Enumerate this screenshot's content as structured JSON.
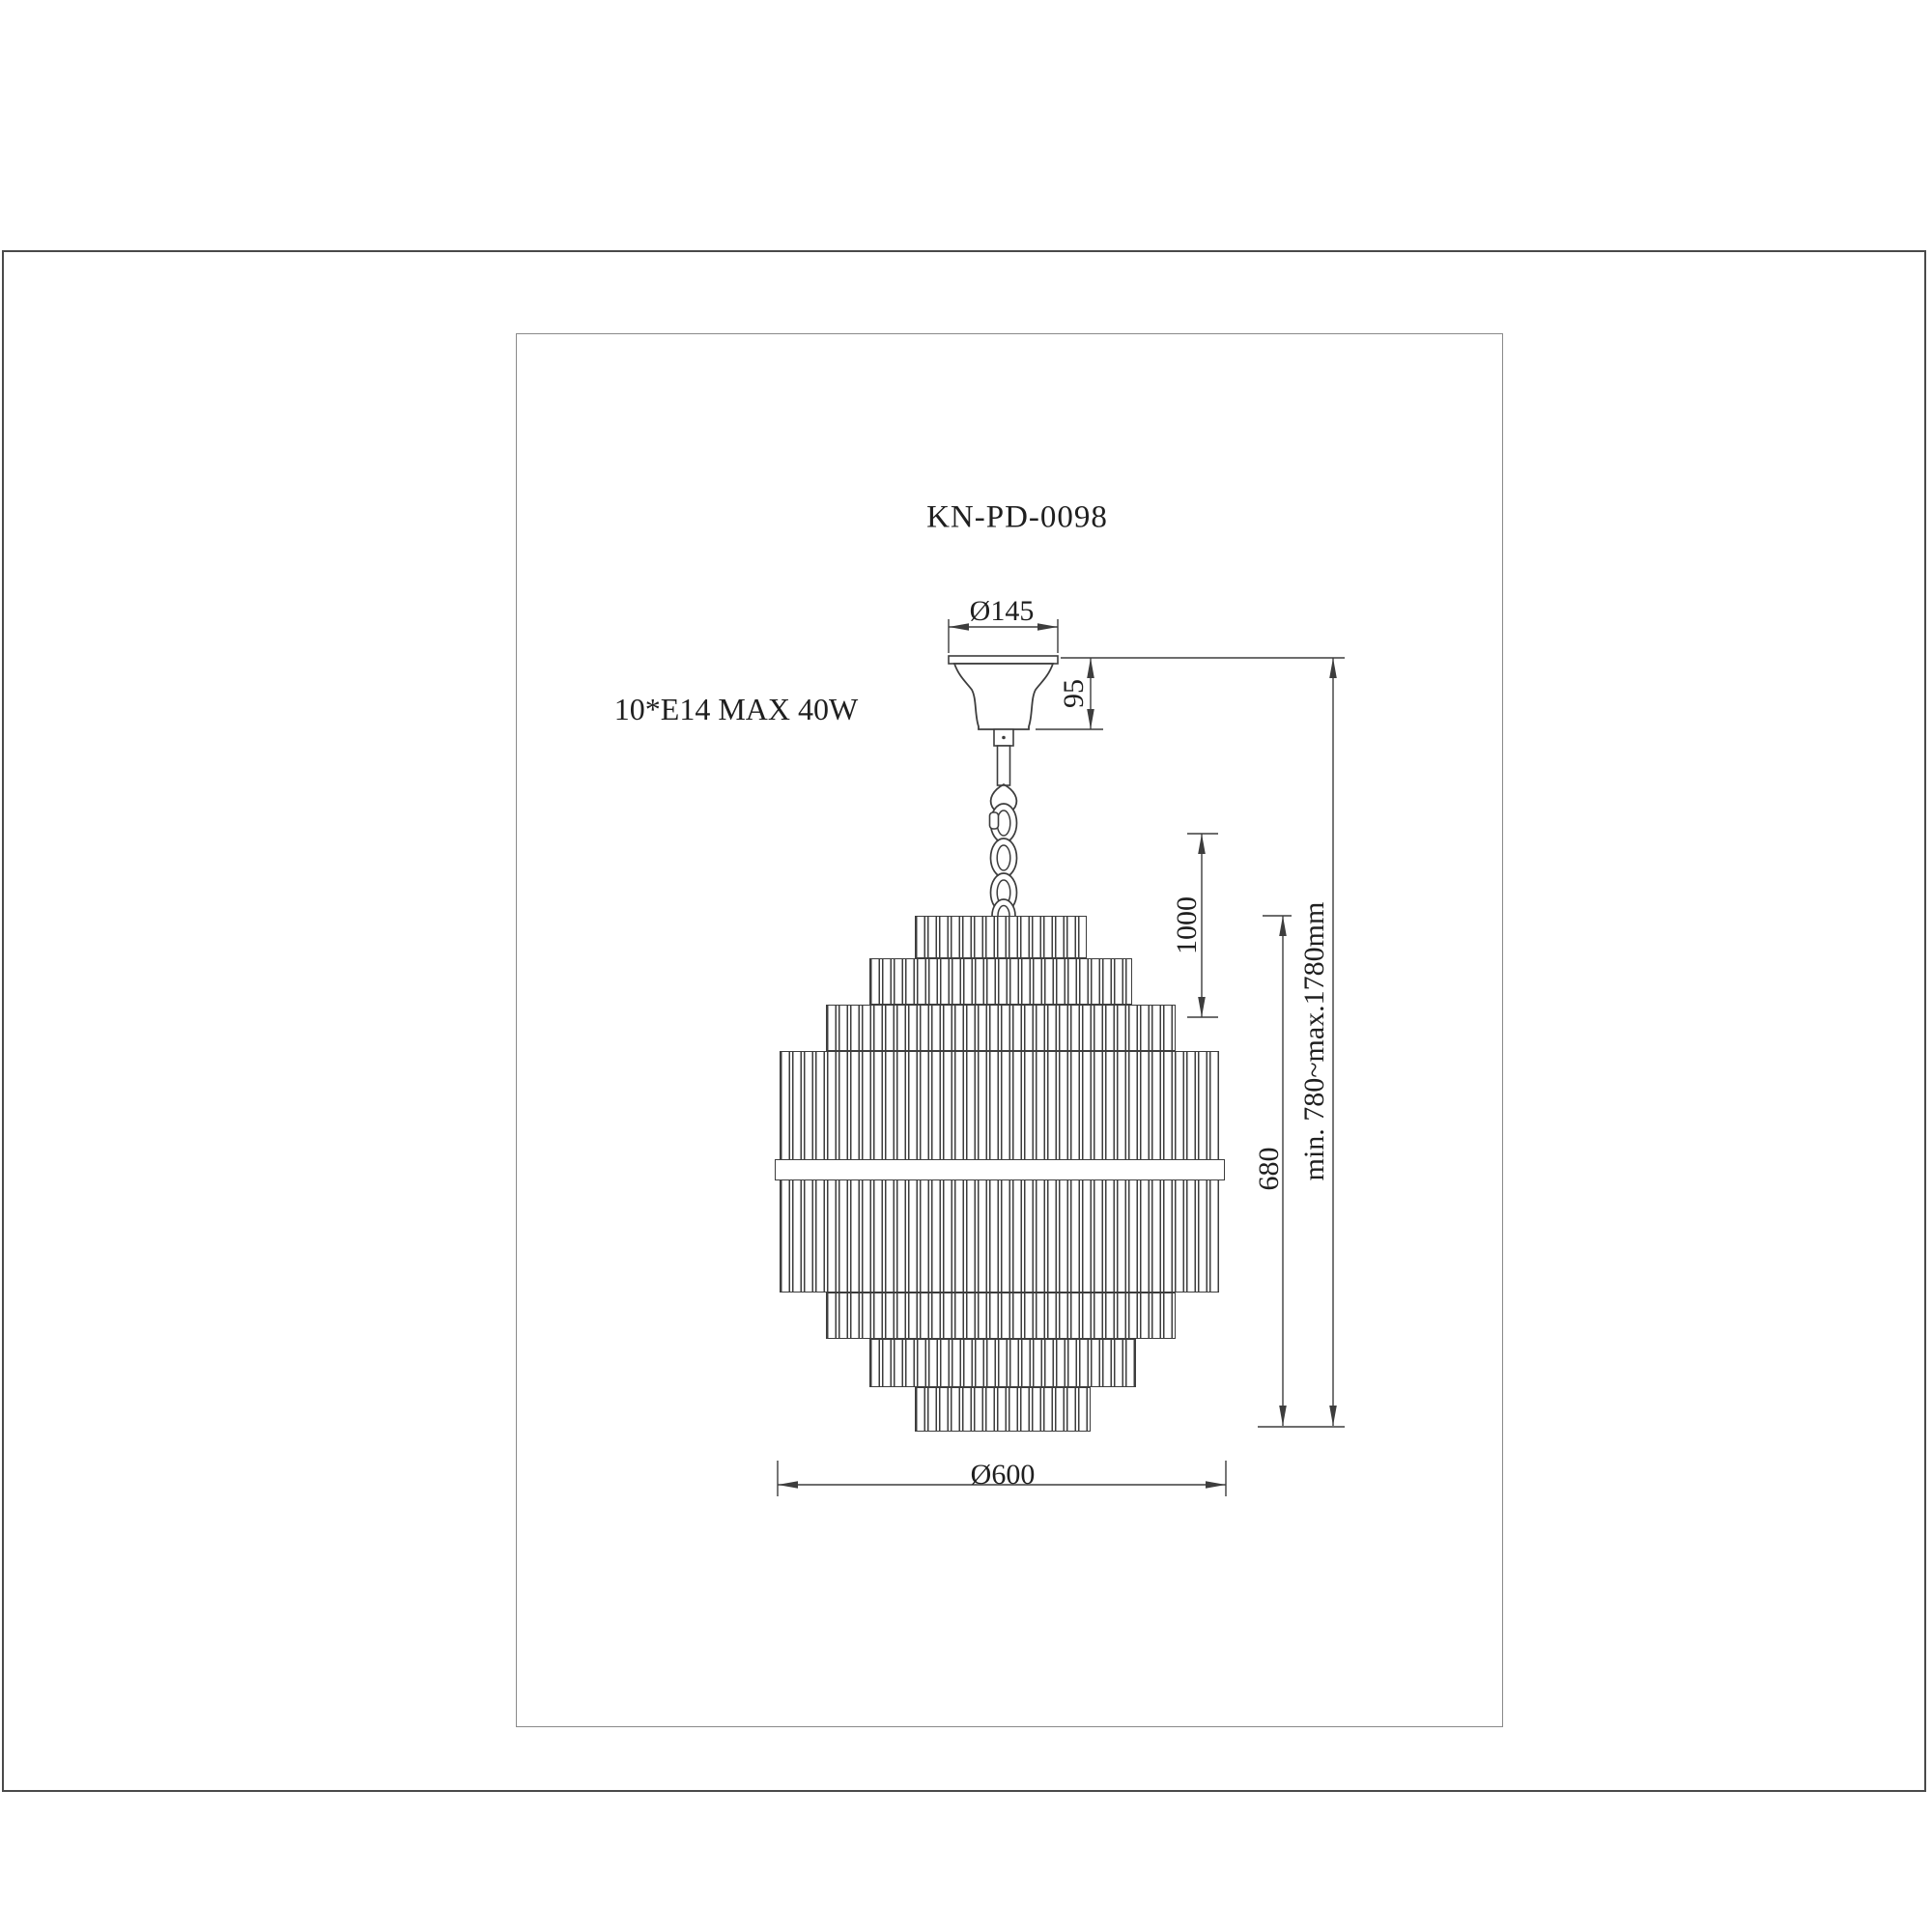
{
  "page": {
    "background": "#ffffff",
    "line_color": "#3d3d3d",
    "text_color": "#1f1f1f"
  },
  "drawing": {
    "model_number": "KN-PD-0098",
    "bulb_spec": "10*E14 MAX 40W",
    "dimensions": {
      "canopy_diameter": "Ø145",
      "canopy_height": "95",
      "suspension_length": "1000",
      "body_height": "680",
      "overall_height_range": "min. 780~max.1780mm",
      "body_diameter": "Ø600"
    }
  }
}
